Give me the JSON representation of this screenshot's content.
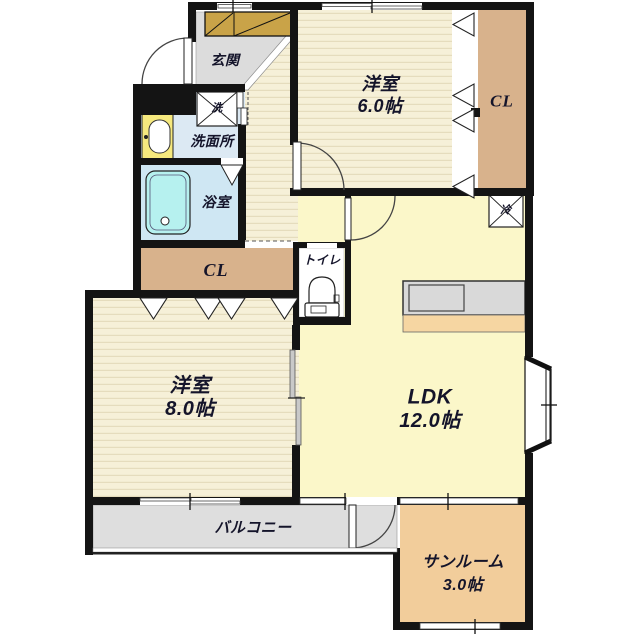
{
  "plan": {
    "type": "floor-plan",
    "rooms": {
      "genkan": {
        "label": "玄関"
      },
      "washer": {
        "label": "洗"
      },
      "washroom": {
        "label": "洗面所"
      },
      "bathroom": {
        "label": "浴室"
      },
      "closet_mid": {
        "label": "CL"
      },
      "toilet": {
        "label": "トイレ"
      },
      "western6": {
        "label": "洋室",
        "size": "6.0帖"
      },
      "closet_top": {
        "label": "CL"
      },
      "fridge": {
        "label": "冷"
      },
      "western8": {
        "label": "洋室",
        "size": "8.0帖"
      },
      "ldk": {
        "label": "LDK",
        "size": "12.0帖"
      },
      "balcony": {
        "label": "バルコニー"
      },
      "sunroom": {
        "label": "サンルーム",
        "size": "3.0帖"
      }
    }
  },
  "colors": {
    "wall": "#141414",
    "tatami": "#f6f0d8",
    "stripe": "#e5dcbd",
    "ldk": "#fbf7c9",
    "closet": "#d8b28c",
    "sunroom": "#f2cd9b",
    "balcony": "#dedede",
    "genkan": "#dcdcdc",
    "washroom": "#dce9f3",
    "bath": "#cfe7f3",
    "tub": "#b6f1ef",
    "sink": "#f6e97e",
    "cabinet": "#c9a348",
    "counter": "#d9d9d9",
    "counter_strip": "#f6d6a2"
  }
}
